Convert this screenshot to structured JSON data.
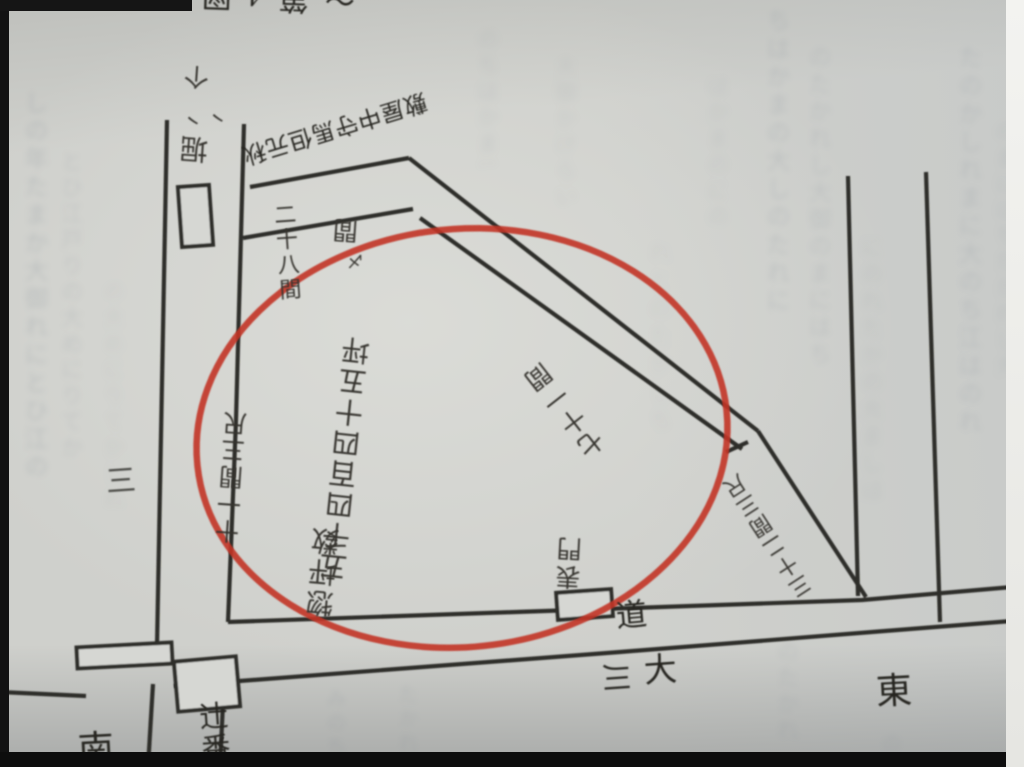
{
  "photo": {
    "caption_fragment": "〜第4図",
    "paper_color": "#cfd0cc",
    "ink_color": "#2e2d29",
    "annotation_color": "#c23528"
  },
  "map": {
    "owner_label": "秋元但馬守中屋敷",
    "area_title": "惣坪数",
    "area_value": "五千四百四十五坪",
    "frontage_label": "二十八間",
    "fragment_ken": "間",
    "fragment_tick": "〆",
    "flow_mark": "个",
    "flow_ticks": "丶丶",
    "canal_label": "堀",
    "depth_label": "十一間三尺",
    "diagonal_label": "七十一間",
    "bank_label": "三十二間三尺",
    "gate_label": "表門",
    "guard_label": "辻番",
    "road_label": "道",
    "river_label_a": "大",
    "river_label_b": "川",
    "compass_east": "東",
    "compass_south": "南",
    "margin_label": "三"
  },
  "bleed": {
    "columns": [
      {
        "x": 16,
        "y": 90,
        "h": 580,
        "fs": 24,
        "op": 0.2,
        "bl": 3,
        "text": "しの年たまか大御れにとひ江の"
      },
      {
        "x": 54,
        "y": 150,
        "h": 420,
        "fs": 22,
        "op": 0.13,
        "bl": 3,
        "text": "とひ江戸りの大めにりてか"
      },
      {
        "x": 96,
        "y": 280,
        "h": 300,
        "fs": 22,
        "op": 0.08,
        "bl": 4,
        "text": "の大めにりてかしれ"
      },
      {
        "x": 320,
        "y": 688,
        "h": 72,
        "fs": 20,
        "op": 0.15,
        "bl": 3,
        "text": "みのち"
      },
      {
        "x": 392,
        "y": 684,
        "h": 78,
        "fs": 20,
        "op": 0.13,
        "bl": 3,
        "text": "たかれ"
      },
      {
        "x": 470,
        "y": 28,
        "h": 140,
        "fs": 22,
        "op": 0.12,
        "bl": 4,
        "text": "のちはかまに"
      },
      {
        "x": 548,
        "y": 55,
        "h": 180,
        "fs": 22,
        "op": 0.1,
        "bl": 4,
        "text": "大御かけらい"
      },
      {
        "x": 640,
        "y": 240,
        "h": 230,
        "fs": 24,
        "op": 0.07,
        "bl": 4,
        "text": "れとのたかしち"
      },
      {
        "x": 700,
        "y": 75,
        "h": 170,
        "fs": 22,
        "op": 0.1,
        "bl": 4,
        "text": "はかまのにの"
      },
      {
        "x": 758,
        "y": 8,
        "h": 310,
        "fs": 24,
        "op": 0.16,
        "bl": 3,
        "text": "ちはかまの大しのたれに江と"
      },
      {
        "x": 800,
        "y": 45,
        "h": 390,
        "fs": 23,
        "op": 0.13,
        "bl": 3,
        "text": "のたかれし大御のまにはち"
      },
      {
        "x": 852,
        "y": 235,
        "h": 330,
        "fs": 23,
        "op": 0.11,
        "bl": 4,
        "text": "にのれたかの大ましは"
      },
      {
        "x": 950,
        "y": 45,
        "h": 580,
        "fs": 24,
        "op": 0.15,
        "bl": 3,
        "text": "たのかしれまに大のち江はのれ"
      },
      {
        "x": 988,
        "y": 120,
        "h": 440,
        "fs": 22,
        "op": 0.12,
        "bl": 4,
        "text": "のまにはちたかれし大"
      },
      {
        "x": 770,
        "y": 640,
        "h": 110,
        "fs": 22,
        "op": 0.12,
        "bl": 3,
        "text": "のたかれ"
      },
      {
        "x": 875,
        "y": 733,
        "h": 30,
        "fs": 20,
        "op": 0.12,
        "bl": 3,
        "text": "のれ"
      }
    ]
  }
}
